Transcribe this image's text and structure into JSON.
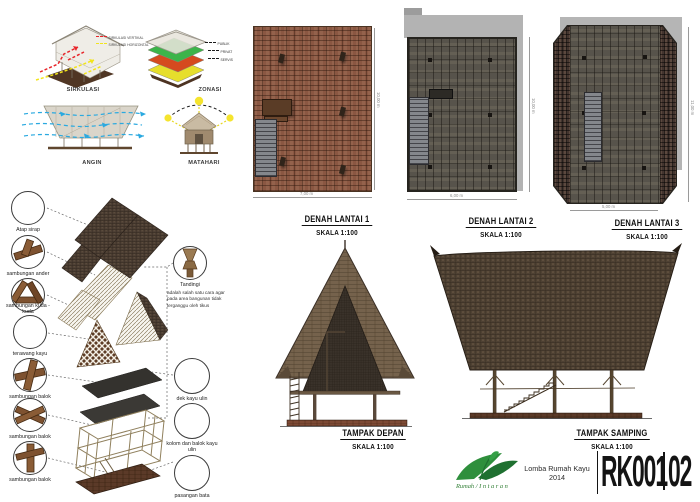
{
  "concepts": {
    "sirkulasi": {
      "label": "SIRKULASI",
      "legend": [
        {
          "label": "SIRKULASI VERTIKAL"
        },
        {
          "label": "SIRKULASI HORIZONTAL"
        }
      ]
    },
    "zonasi": {
      "label": "ZONASI",
      "legend": [
        {
          "label": "PUBLIK"
        },
        {
          "label": "PRIVAT"
        },
        {
          "label": "SERVIS"
        }
      ]
    },
    "angin": {
      "label": "ANGIN"
    },
    "matahari": {
      "label": "MATAHARI"
    }
  },
  "axon": {
    "left_callouts": [
      {
        "label": "Atap sirap"
      },
      {
        "label": "sambungan ander"
      },
      {
        "label": "sambungan kuda - kuda"
      },
      {
        "label": "terawang kayu"
      },
      {
        "label": "sambungan balok"
      },
      {
        "label": "sambungan balok"
      },
      {
        "label": "sambungan balok"
      }
    ],
    "right_callouts": [
      {
        "label": "Tandingi",
        "description": "adalah salah satu cara agar pada area bangunan tidak terganggu oleh tikus"
      },
      {
        "label": "dek kayu ulin"
      },
      {
        "label": "kolom dan balok kayu ulin"
      },
      {
        "label": "pasangan bata"
      }
    ]
  },
  "plans": [
    {
      "title": "DENAH LANTAI 1",
      "scale": "SKALA 1:100",
      "width_dim": "7,00 m",
      "height_dim": "10,00 m"
    },
    {
      "title": "DENAH LANTAI 2",
      "scale": "SKALA 1:100",
      "width_dim": "6,00 m",
      "height_dim": "10,00 m"
    },
    {
      "title": "DENAH LANTAI 3",
      "scale": "SKALA 1:100",
      "width_dim": "5,00 m",
      "height_dim": "11,00 m"
    }
  ],
  "elevations": [
    {
      "title": "TAMPAK DEPAN",
      "scale": "SKALA 1:100"
    },
    {
      "title": "TAMPAK SAMPING",
      "scale": "SKALA 1:100"
    }
  ],
  "title_block": {
    "studio_name_left": "Rumah",
    "studio_name_right": "Intaran",
    "competition": "Lomba Rumah Kayu",
    "year": "2014",
    "sheet_code": "RK001",
    "sheet_number": "02"
  },
  "colors": {
    "zonasi_green": "#3cb44a",
    "zonasi_orange": "#d54a1f",
    "zonasi_yellow": "#e6de2c",
    "wind_blue": "#2aa9e0",
    "circulation_red": "#e8252a",
    "circulation_yellow": "#f2e41c",
    "logo_green": "#2e8f3c"
  }
}
